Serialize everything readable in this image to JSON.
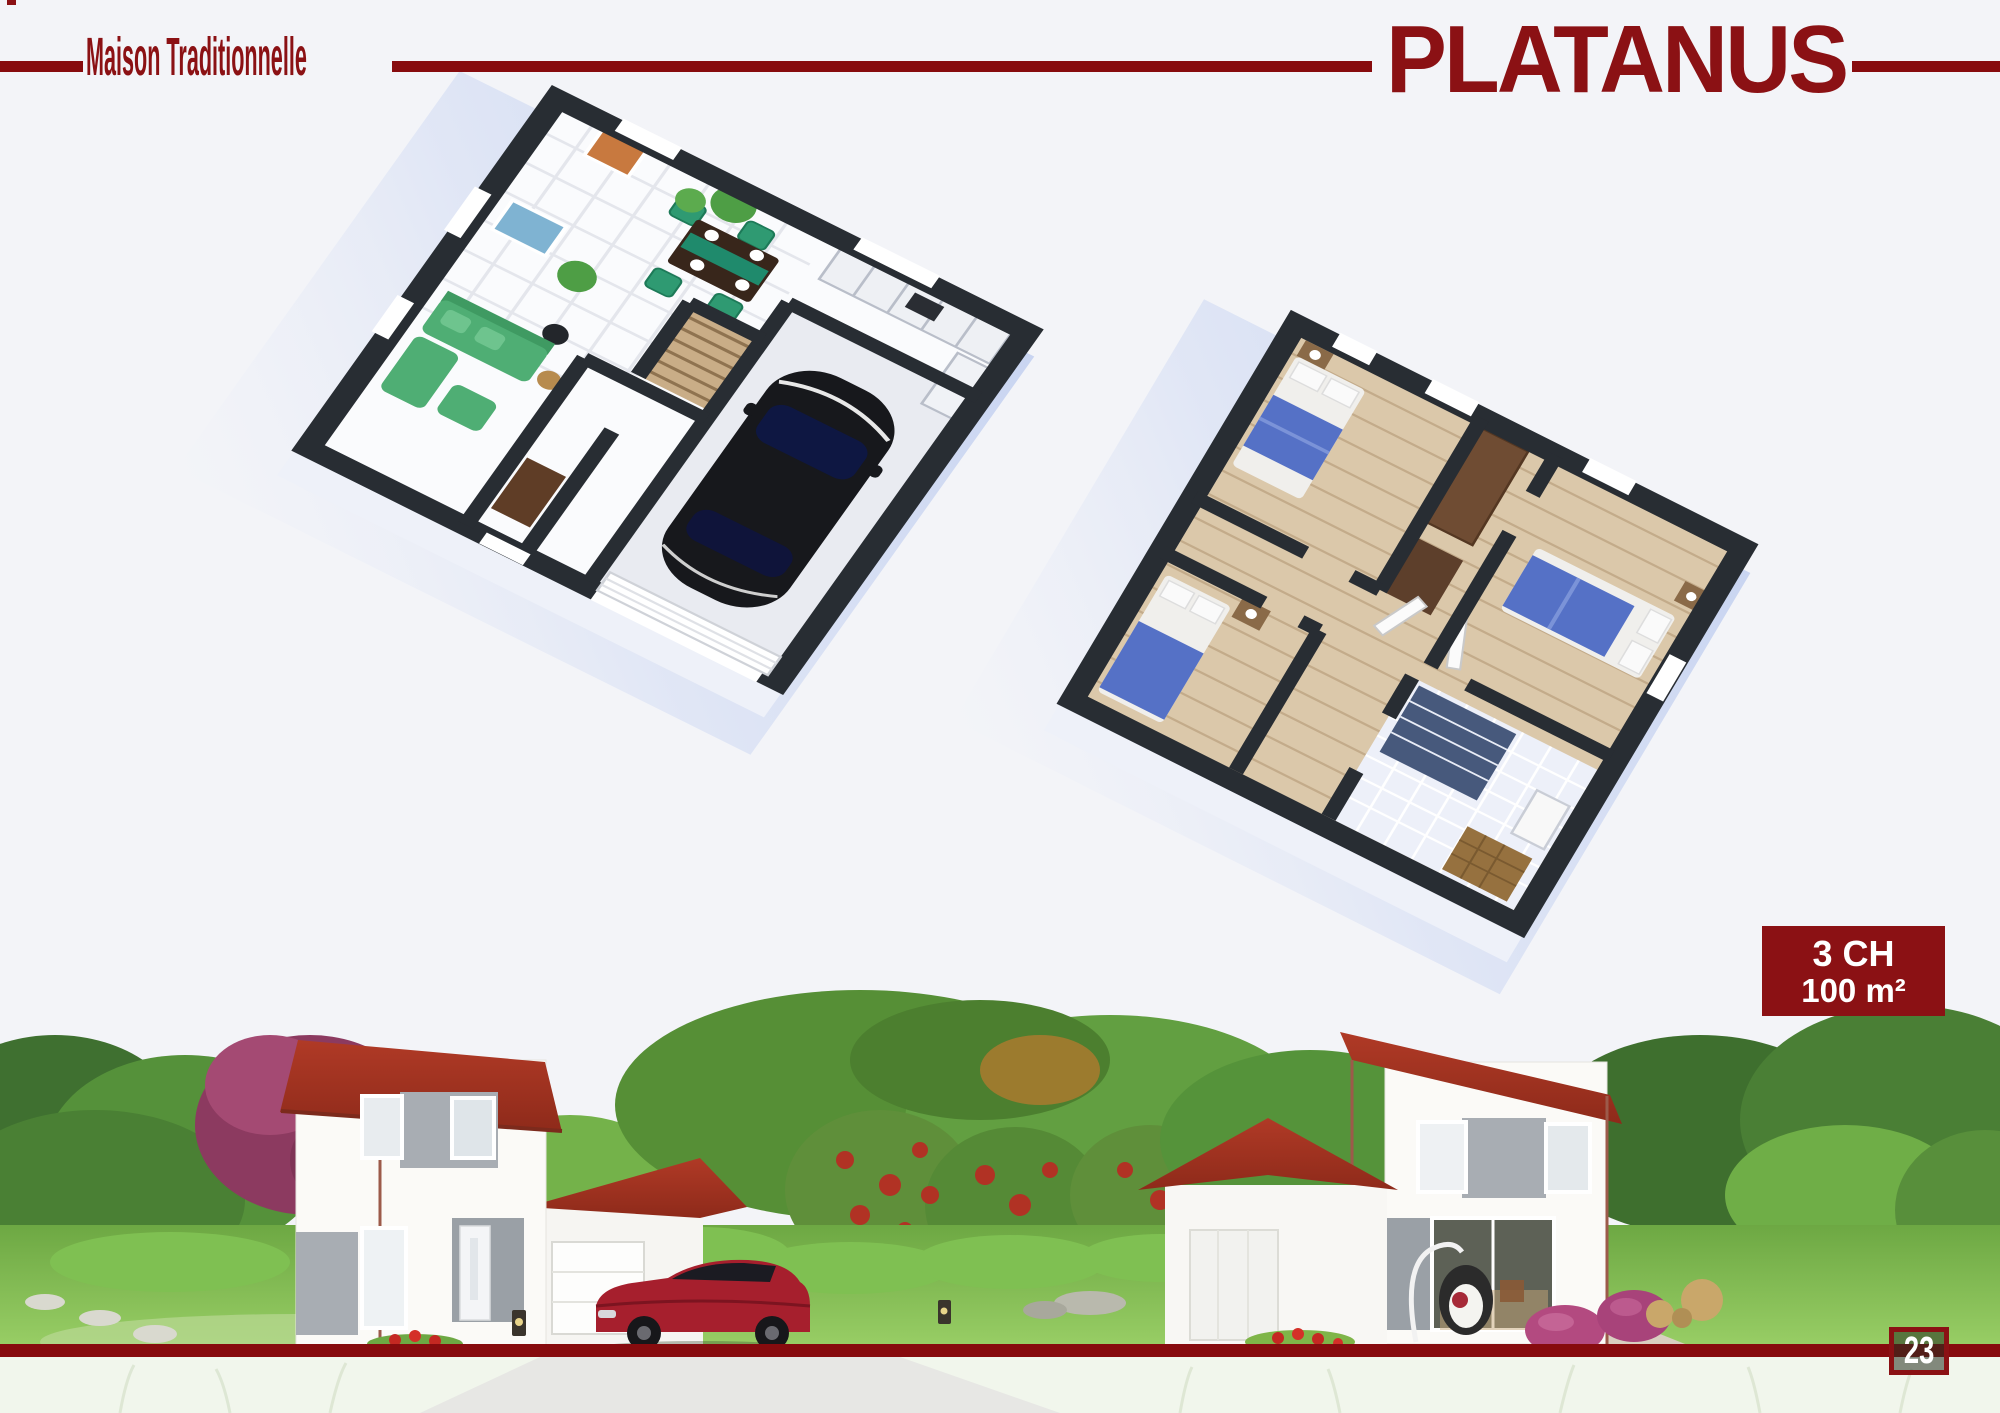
{
  "header": {
    "collection_label": "Maison Traditionnelle",
    "model_name": "PLATANUS"
  },
  "badge": {
    "bedrooms": "3 CH",
    "area": "100 m²"
  },
  "footer": {
    "page_number": "23"
  },
  "colors": {
    "page-bg": "#f3f4f8",
    "accent": "#8b1114",
    "rule-red": "#870b0e",
    "roof-red": "#a23524",
    "wall-dark": "#282d33",
    "plan-shadow": "#c4d1f0",
    "grass-green": "#74ad47",
    "sofa-green": "#4fae74",
    "bed-blue": "#5571c6",
    "car-red": "#a61f2d",
    "beanbag-pink": "#b34a80"
  }
}
